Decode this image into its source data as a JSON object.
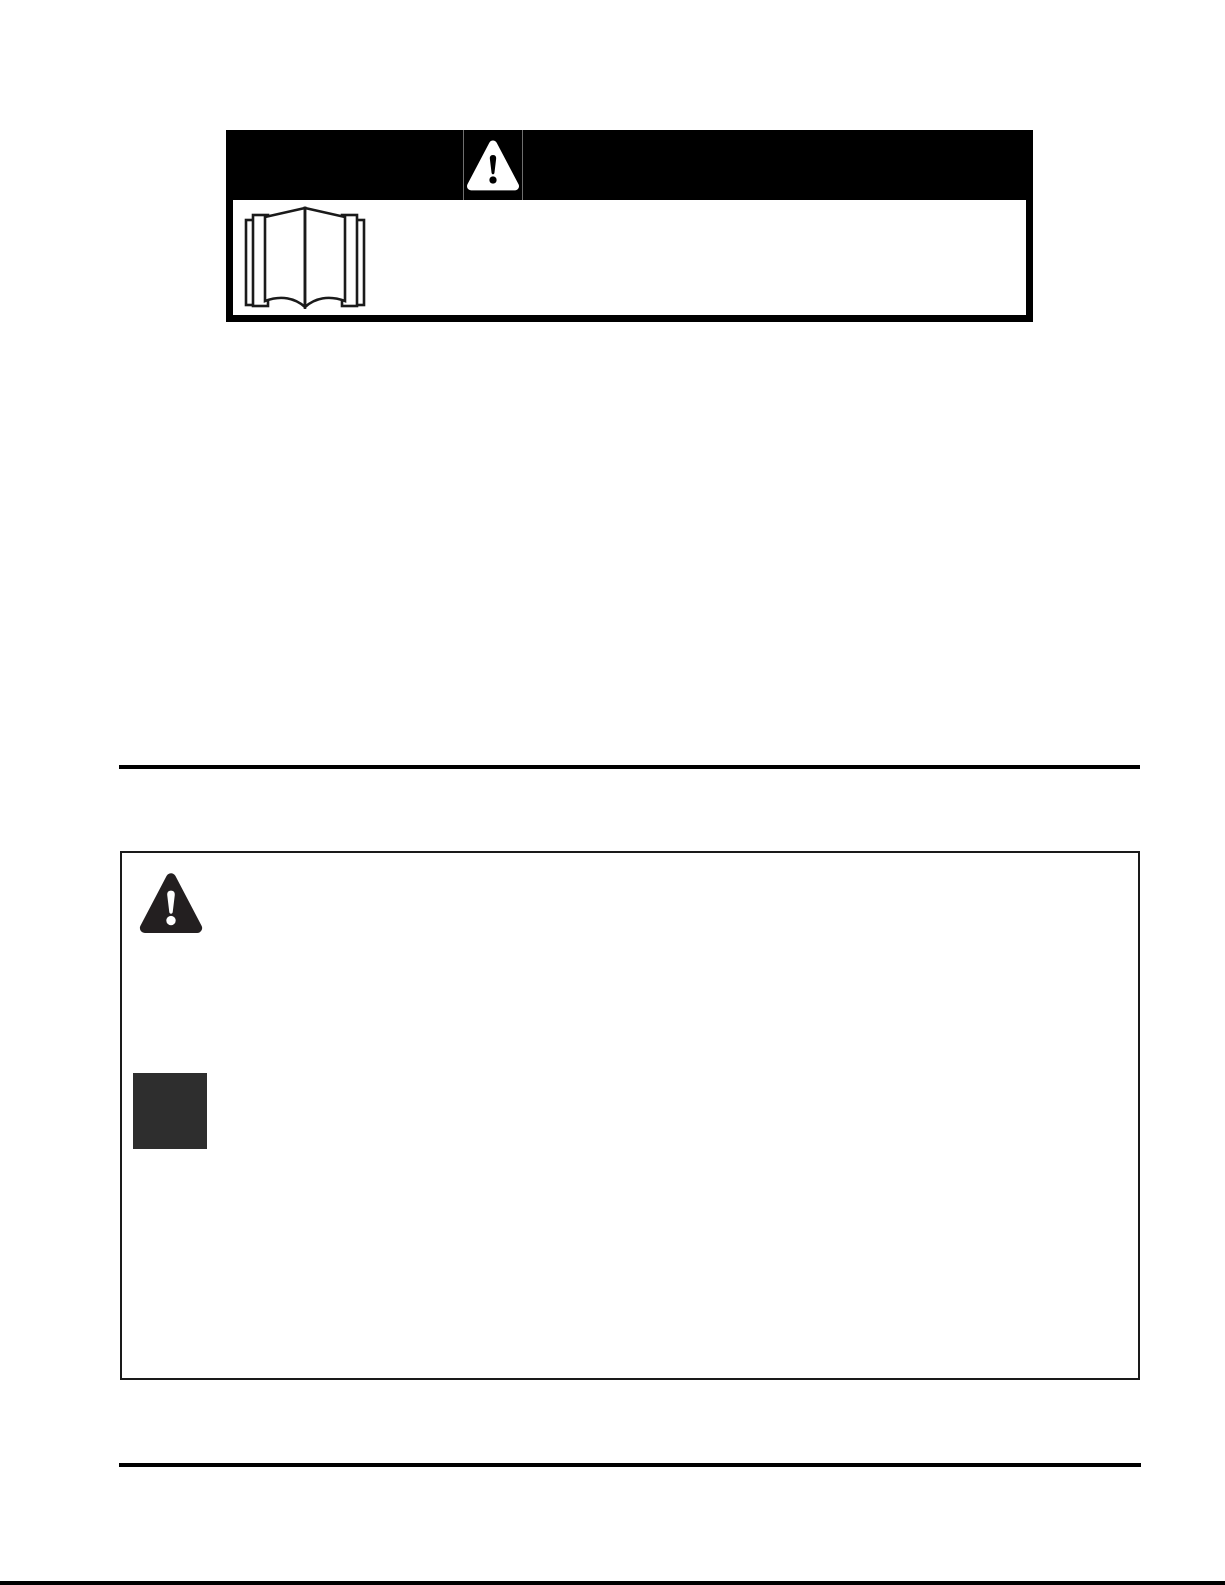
{
  "page": {
    "kind": "safety-manual-page-scan",
    "background": "#ffffff",
    "ink": "#000000"
  },
  "alert_header": {
    "band_color": "#000000",
    "divider_color": "#6e6e6e",
    "alert_icon": "warning-triangle-icon",
    "alert_icon_triangle_color": "#ffffff",
    "alert_icon_mark_color": "#000000",
    "manual_icon": "open-book-icon",
    "manual_icon_stroke": "#1a1a1a",
    "manual_icon_fill": "#ffffff"
  },
  "safety_box": {
    "border_color": "#1a1a1a",
    "alert_icon": "warning-triangle-icon",
    "alert_icon_triangle_color": "#231f20",
    "alert_icon_mark_color": "#ffffff",
    "square_color": "#2e2e2e"
  },
  "rules": {
    "color": "#000000"
  },
  "page_edge": {
    "color": "#000000"
  }
}
